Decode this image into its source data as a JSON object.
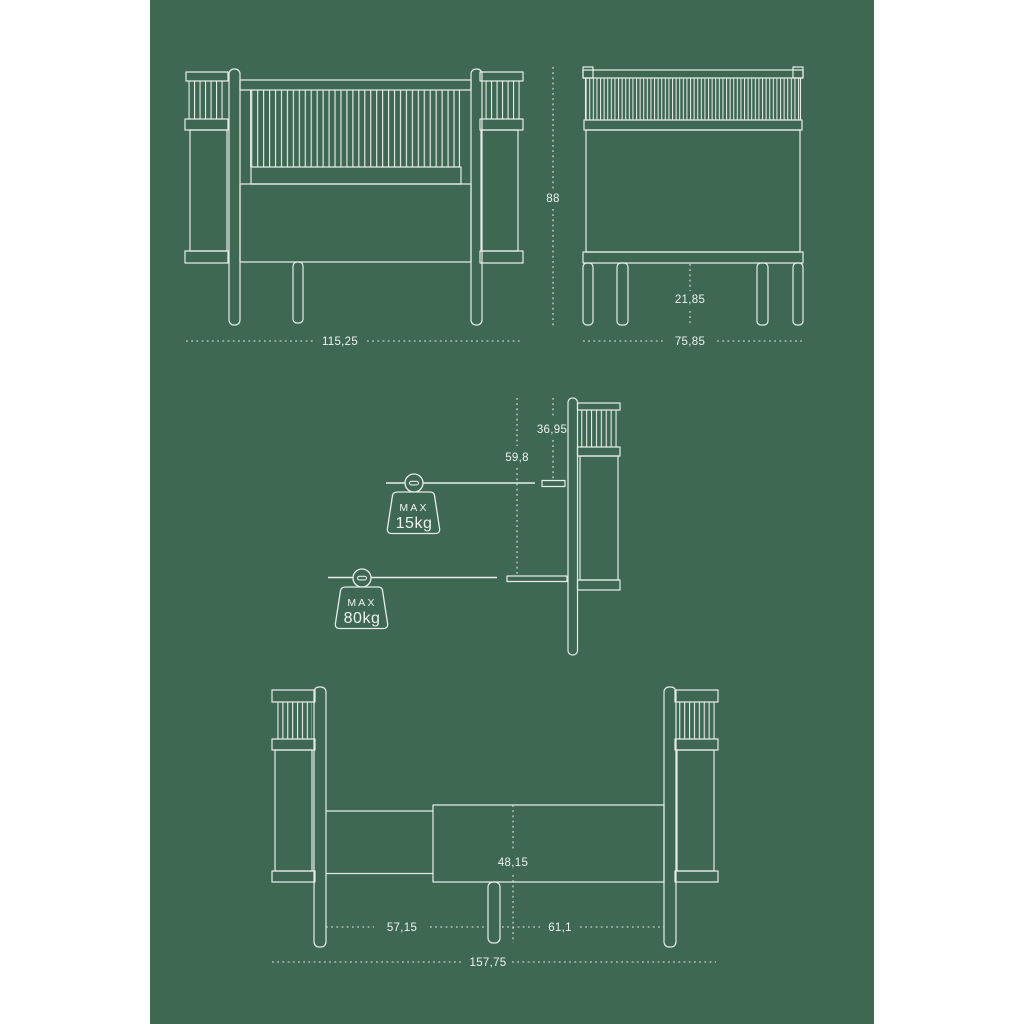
{
  "colors": {
    "page_background": "#ffffff",
    "poster_background": "#3e6852",
    "line": "#e7ece7",
    "text": "#eef3ee"
  },
  "dimensions": {
    "front_width": "115,25",
    "overall_height": "88",
    "side_width": "75,85",
    "underbed_clearance": "21,85",
    "mattress_height_high": "36,95",
    "mattress_height_low": "59,8",
    "junior_left_section": "57,15",
    "junior_right_section": "61,1",
    "junior_base_height": "48,15",
    "junior_total_width": "157,75"
  },
  "weight_limits": {
    "crib_mode": {
      "prefix": "MAX",
      "value": "15kg"
    },
    "junior_mode": {
      "prefix": "MAX",
      "value": "80kg"
    }
  }
}
